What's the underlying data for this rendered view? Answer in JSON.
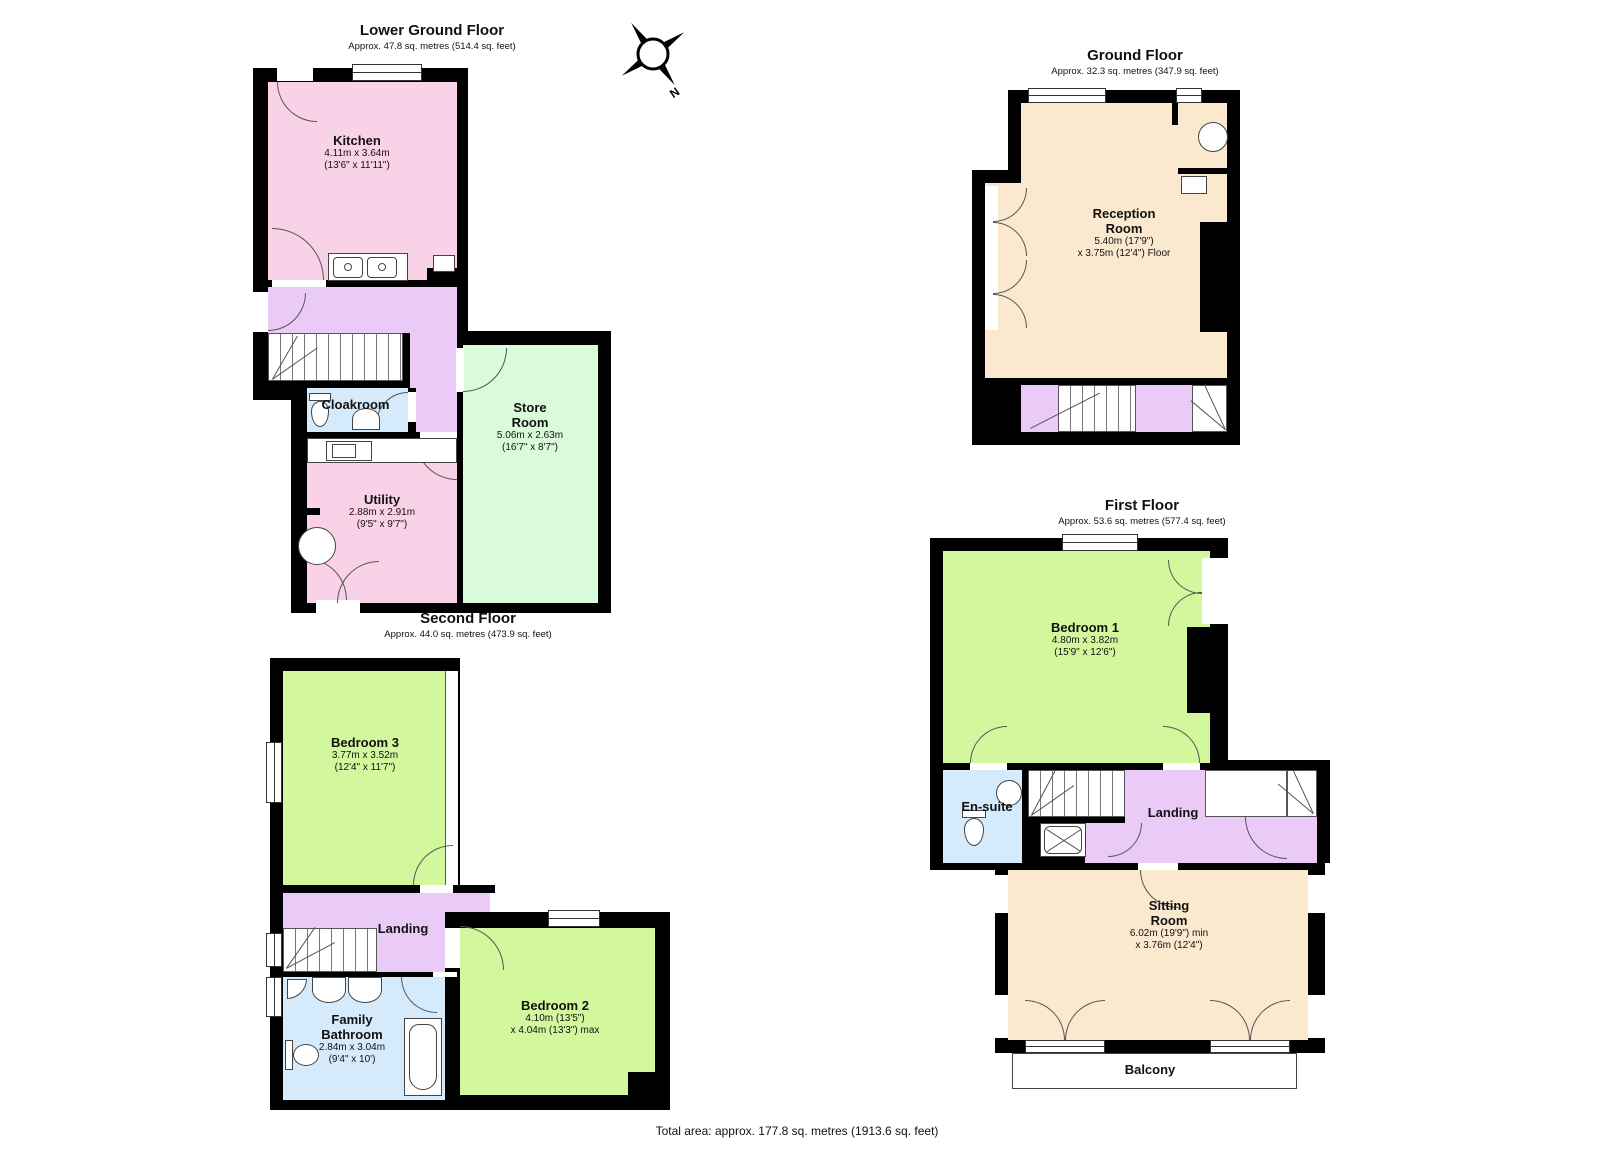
{
  "floors": [
    {
      "id": "lower-ground-floor",
      "title": "Lower Ground Floor",
      "subtitle": "Approx. 47.8 sq. metres (514.4 sq. feet)",
      "rooms": [
        {
          "name_lines": [
            "Kitchen"
          ],
          "dims": [
            "4.11m x 3.64m",
            "(13'6\" x 11'11\")"
          ]
        },
        {
          "name_lines": [
            "Cloakroom"
          ],
          "dims": []
        },
        {
          "name_lines": [
            "Utility"
          ],
          "dims": [
            "2.88m x 2.91m",
            "(9'5\" x 9'7\")"
          ]
        },
        {
          "name_lines": [
            "Store",
            "Room"
          ],
          "dims": [
            "5.06m x 2.63m",
            "(16'7\" x 8'7\")"
          ]
        }
      ]
    },
    {
      "id": "ground-floor",
      "title": "Ground Floor",
      "subtitle": "Approx. 32.3 sq. metres (347.9 sq. feet)",
      "rooms": [
        {
          "name_lines": [
            "Reception",
            "Room"
          ],
          "dims": [
            "5.40m (17'9\")",
            "x 3.75m (12'4\") Floor"
          ]
        }
      ]
    },
    {
      "id": "first-floor",
      "title": "First Floor",
      "subtitle": "Approx. 53.6 sq. metres (577.4 sq. feet)",
      "rooms": [
        {
          "name_lines": [
            "Bedroom 1"
          ],
          "dims": [
            "4.80m x 3.82m",
            "(15'9\" x 12'6\")"
          ]
        },
        {
          "name_lines": [
            "En-suite"
          ],
          "dims": []
        },
        {
          "name_lines": [
            "Landing"
          ],
          "dims": []
        },
        {
          "name_lines": [
            "Sitting",
            "Room"
          ],
          "dims": [
            "6.02m (19'9\") min",
            "x 3.76m (12'4\")"
          ]
        },
        {
          "name_lines": [
            "Balcony"
          ],
          "dims": []
        }
      ]
    },
    {
      "id": "second-floor",
      "title": "Second Floor",
      "subtitle": "Approx. 44.0 sq. metres (473.9 sq. feet)",
      "rooms": [
        {
          "name_lines": [
            "Bedroom 3"
          ],
          "dims": [
            "3.77m x 3.52m",
            "(12'4\" x 11'7\")"
          ]
        },
        {
          "name_lines": [
            "Landing"
          ],
          "dims": []
        },
        {
          "name_lines": [
            "Family",
            "Bathroom"
          ],
          "dims": [
            "2.84m x 3.04m",
            "(9'4\" x 10')"
          ]
        },
        {
          "name_lines": [
            "Bedroom 2"
          ],
          "dims": [
            "4.10m (13'5\")",
            "x 4.04m (13'3\") max"
          ]
        }
      ]
    }
  ],
  "compass": {
    "label": "N"
  },
  "total_area": "Total area: approx. 177.8 sq. metres (1913.6 sq. feet)",
  "colors": {
    "pink": "#FAD2E8",
    "purple": "#EACBF8",
    "blue": "#D5EBFB",
    "green": "#D2F79C",
    "mint": "#DAFBDA",
    "cream": "#FBE9CF",
    "wall": "#000000"
  }
}
